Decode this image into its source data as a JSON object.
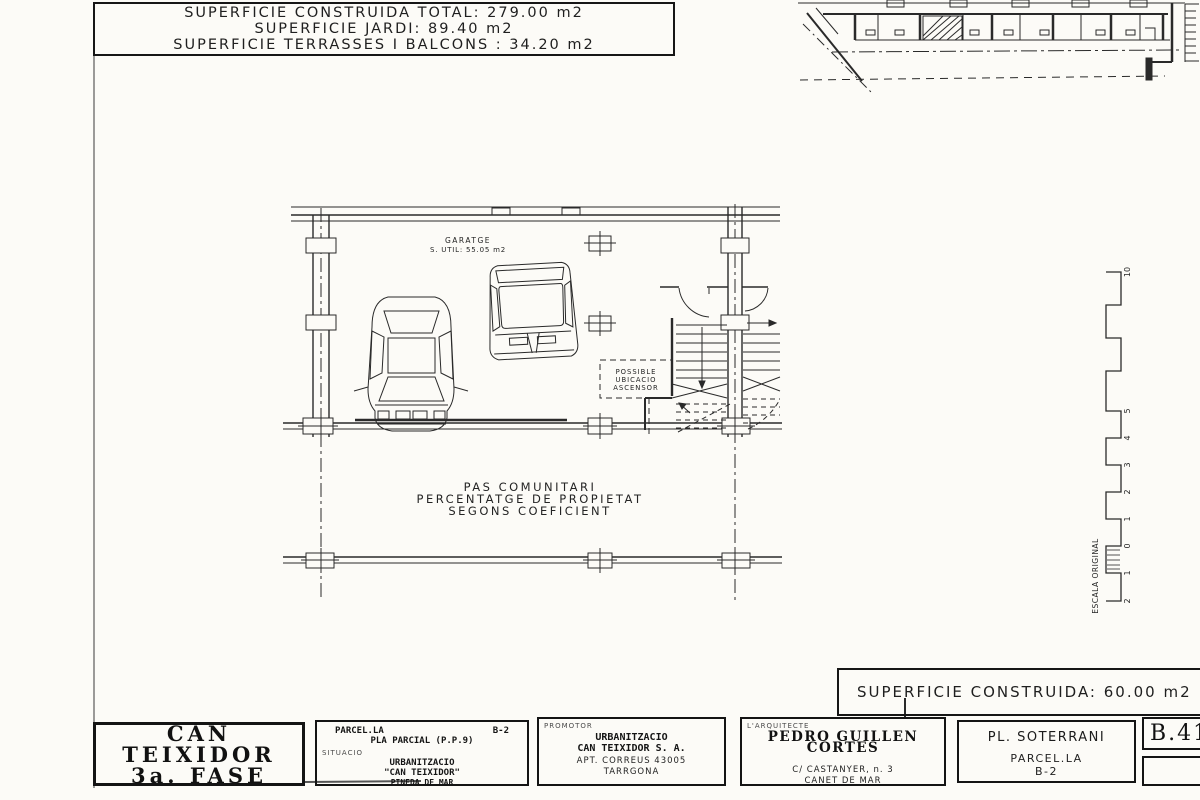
{
  "colors": {
    "ink": "#242424",
    "paper": "#fcfbf7"
  },
  "summary_box": {
    "line1": "SUPERFICIE CONSTRUIDA TOTAL: 279.00 m2",
    "line2": "SUPERFICIE JARDI: 89.40 m2",
    "line3": "SUPERFICIE TERRASSES I BALCONS : 34.20 m2"
  },
  "plan": {
    "garage_label": "GARATGE",
    "garage_area": "S. UTIL: 55.05 m2",
    "elevator": {
      "line1": "POSSIBLE",
      "line2": "UBICACIO",
      "line3": "ASCENSOR"
    },
    "communal": {
      "line1": "PAS COMUNITARI",
      "line2": "PERCENTATGE DE PROPIETAT",
      "line3": "SEGONS COEFICIENT"
    }
  },
  "scale_bar": {
    "label": "ESCALA ORIGINAL",
    "ticks": [
      "10",
      "5",
      "4",
      "3",
      "2",
      "1",
      "0",
      "1",
      "2"
    ]
  },
  "area_box": {
    "text": "SUPERFICIE CONSTRUIDA: 60.00 m2"
  },
  "title_block": {
    "project": {
      "line1": "CAN",
      "line2": "TEIXIDOR",
      "line3": "3a. FASE"
    },
    "situacio": {
      "parcel": "PARCEL.LA",
      "parcel_num": "B-2",
      "pla": "PLA PARCIAL (P.P.9)",
      "label": "SITUACIO",
      "urb": "URBANITZACIO",
      "urb_name": "\"CAN TEIXIDOR\"",
      "city": "PINEDA DE MAR"
    },
    "promotor": {
      "label": "PROMOTOR",
      "line1": "URBANITZACIO",
      "line2": "CAN TEIXIDOR S. A.",
      "line3": "APT. CORREUS 43005",
      "line4": "TARRGONA"
    },
    "arquitecte": {
      "label": "L'ARQUITECTE",
      "name": "PEDRO GUILLEN CORTES",
      "addr1": "C/ CASTANYER, n. 3",
      "addr2": "CANET DE MAR"
    },
    "sheet": {
      "title": "PL. SOTERRANI",
      "sub1": "PARCEL.LA",
      "sub2": "B-2"
    },
    "number": {
      "code": "B.41"
    }
  }
}
